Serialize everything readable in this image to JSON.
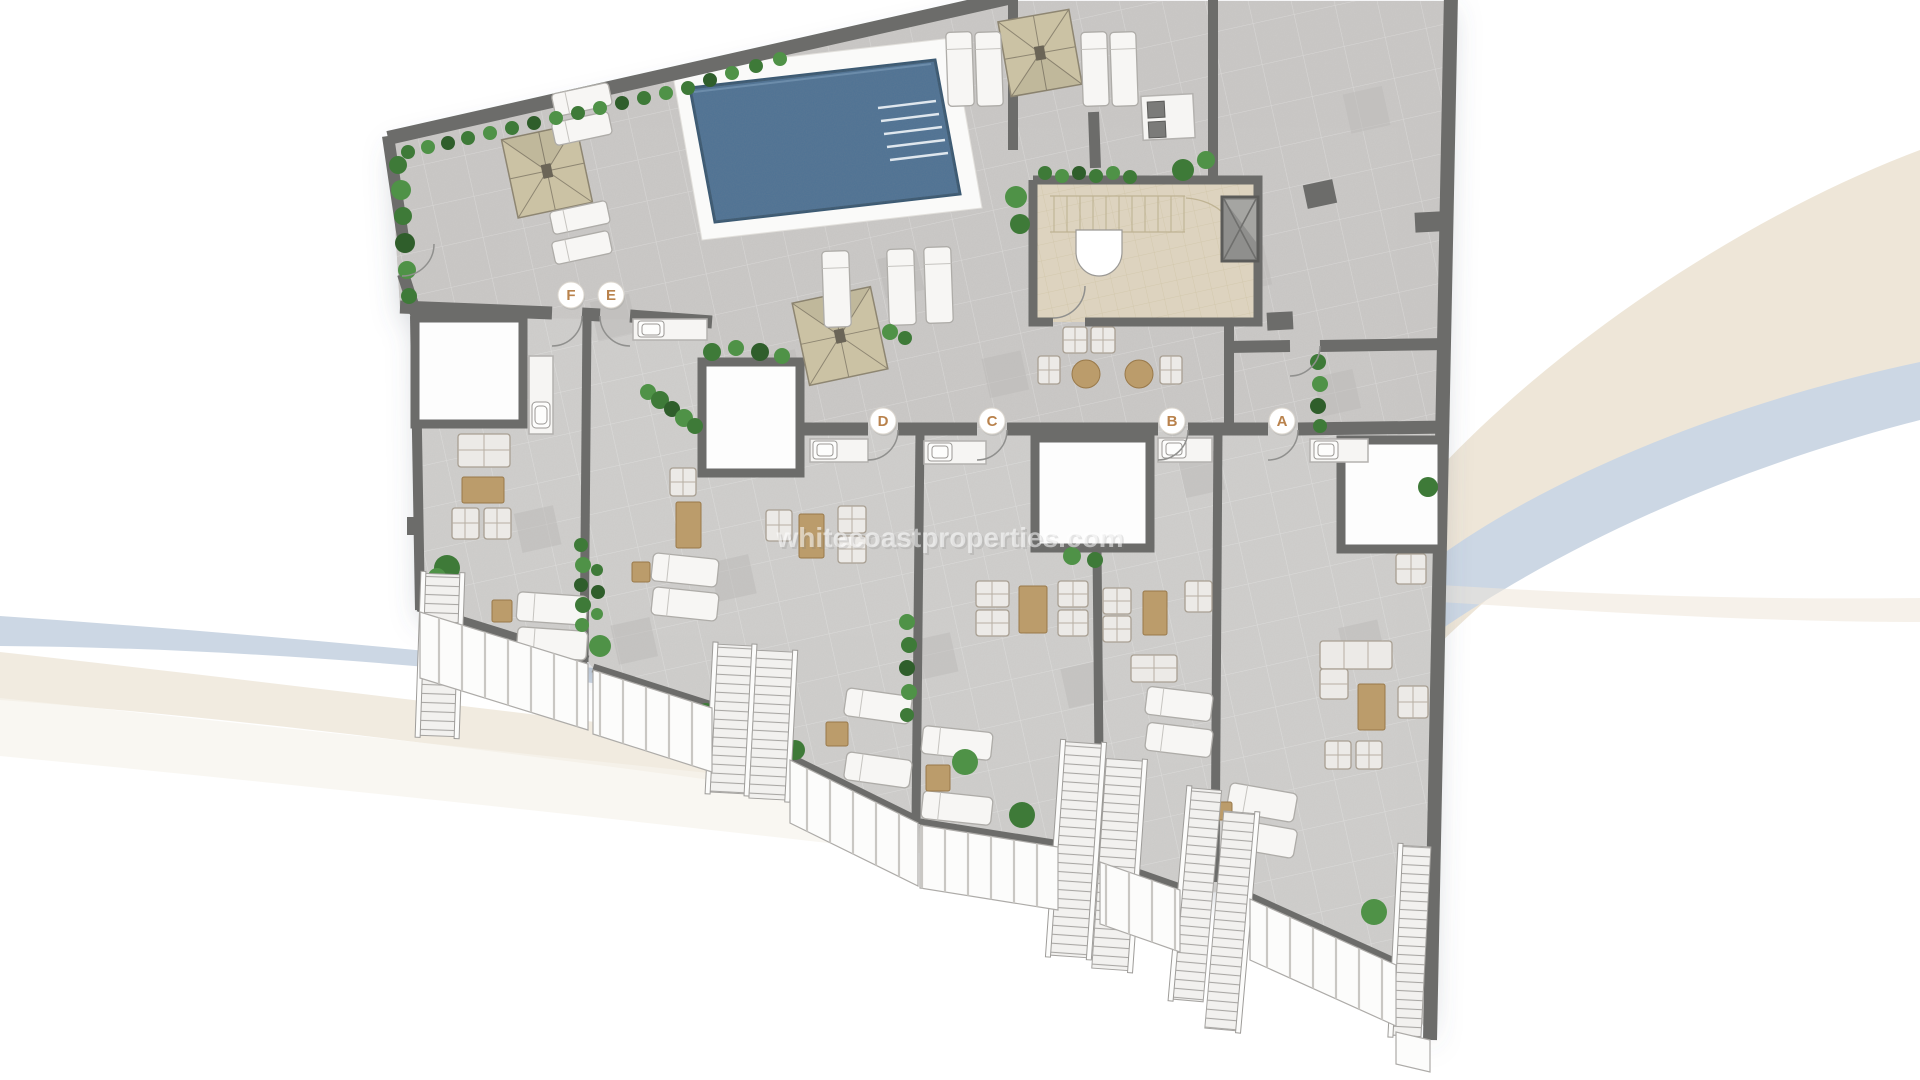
{
  "watermark": {
    "text": "whitecoastproperties.com"
  },
  "units": [
    {
      "label": "F"
    },
    {
      "label": "E"
    },
    {
      "label": "D"
    },
    {
      "label": "C"
    },
    {
      "label": "B"
    },
    {
      "label": "A"
    }
  ],
  "colors": {
    "floor": "#cbc9c7",
    "terrace_floor": "#d6d4d2",
    "wall": "#6c6c6a",
    "pool_water": "#4e7396",
    "pool_deck": "#fafaf9",
    "pergola": "#cbc2a4",
    "plant": "#3e7a38",
    "timber": "#bb9c6b",
    "core_floor": "#ddd3bf",
    "label_text": "#b9824c",
    "swoosh_blue": "#ccd7e4",
    "swoosh_beige": "#eee6d8",
    "railing": "#fcfcfb"
  }
}
